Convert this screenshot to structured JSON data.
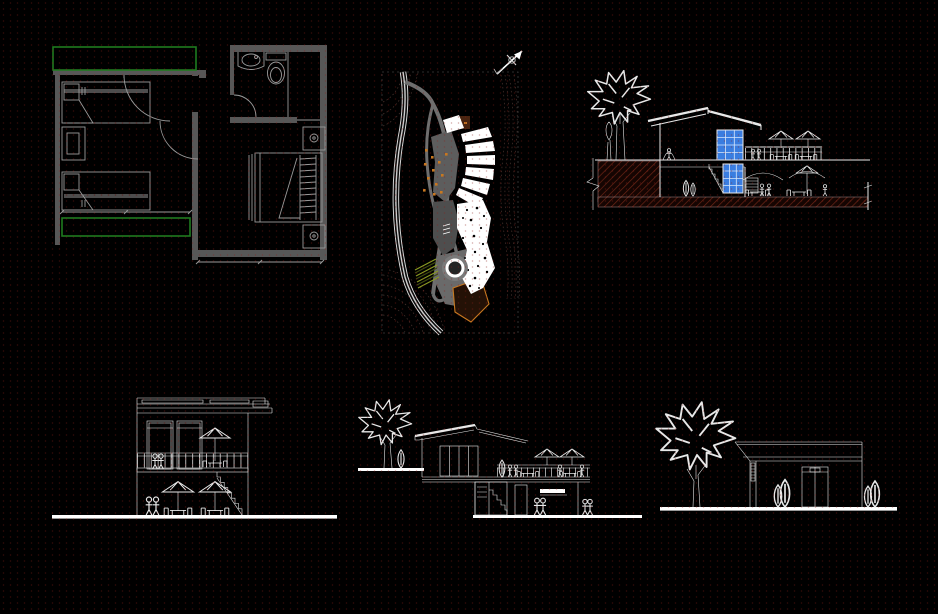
{
  "colors": {
    "background": "#000000",
    "line": "#e8e8e8",
    "wall_gray": "#575757",
    "green": "#1f7a1f",
    "glass_blue": "#3a7de0",
    "glass_mullion": "#d8e6fa",
    "earth_fill": "#150502",
    "earth_hatch": "#6b2416",
    "orange": "#c87820",
    "olive": "#8a9a22",
    "road_gray": "#6e6e6e",
    "contour": "#4a332e",
    "ground_white": "#ffffff"
  },
  "panels": [
    {
      "id": "floor-plan",
      "label": "floor plan - bedrooms and bathroom"
    },
    {
      "id": "site-plan",
      "label": "site plan with road, contours and north arrow"
    },
    {
      "id": "section",
      "label": "cross section with ground hatch, glazing and terrace"
    },
    {
      "id": "rear-elevation",
      "label": "two storey elevation with terrace"
    },
    {
      "id": "side-elevation",
      "label": "side elevation with deck and lower level"
    },
    {
      "id": "front-elevation",
      "label": "front elevation with tree and entry door"
    }
  ]
}
